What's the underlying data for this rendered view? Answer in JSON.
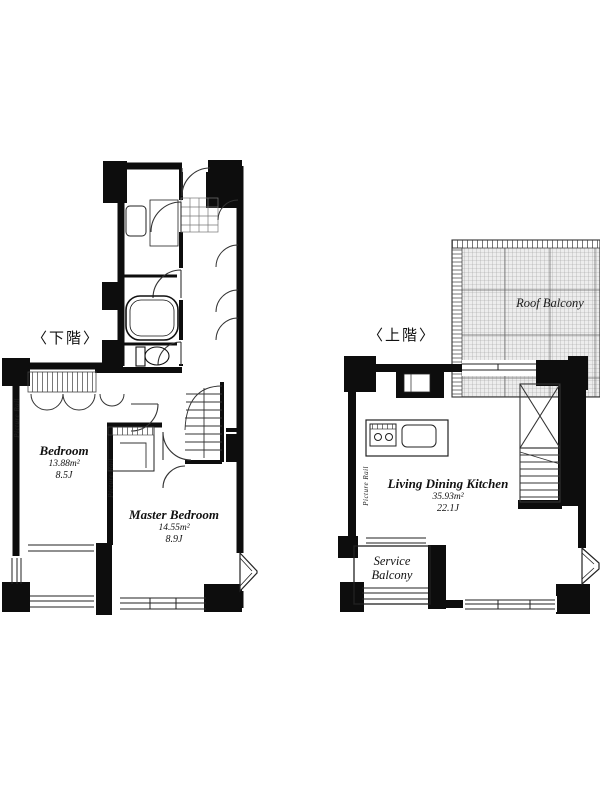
{
  "floorplan": {
    "lower": {
      "label": "〈下階〉",
      "bedroom": {
        "name": "Bedroom",
        "area": "13.88m²",
        "size": "8.5J"
      },
      "master": {
        "name": "Master Bedroom",
        "area": "14.55m²",
        "size": "8.9J"
      },
      "picture_rail_1": "Picture Rail",
      "picture_rail_2": "Picture Rail"
    },
    "upper": {
      "label": "〈上階〉",
      "ldk": {
        "name": "Living Dining Kitchen",
        "area": "35.93m²",
        "size": "22.1J"
      },
      "service_balcony": "Service\nBalcony",
      "roof_balcony": "Roof Balcony",
      "picture_rail": "Picture Rail"
    }
  }
}
